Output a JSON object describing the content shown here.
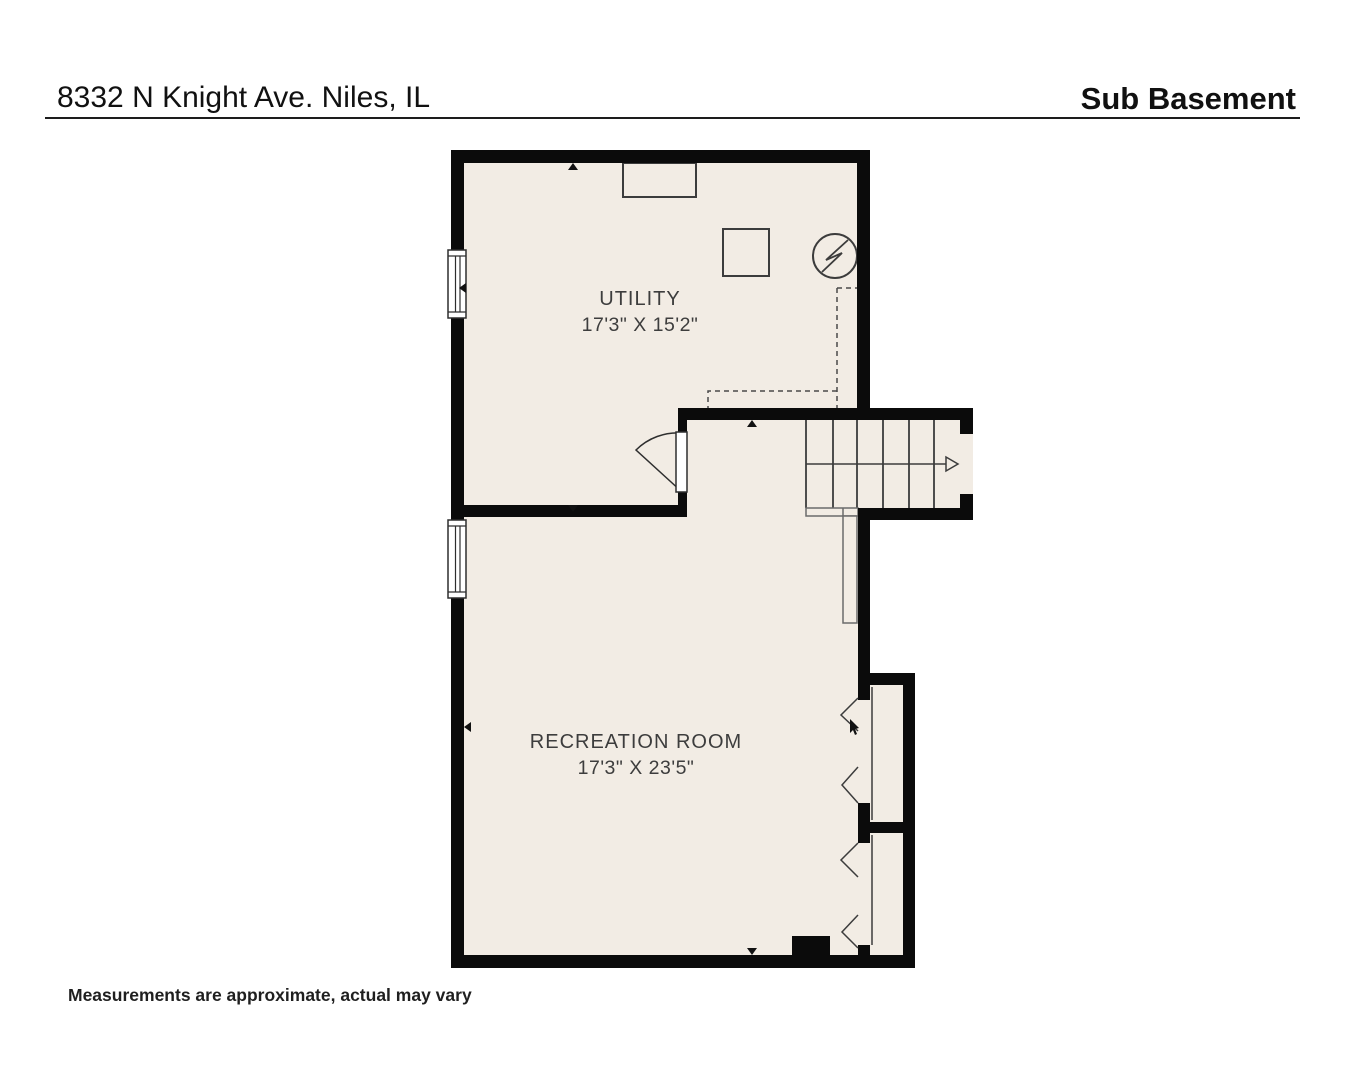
{
  "header": {
    "address": "8332 N Knight Ave. Niles, IL",
    "plan_title": "Sub Basement"
  },
  "rooms": [
    {
      "name": "UTILITY",
      "dimensions": "17'3\" X 15'2\""
    },
    {
      "name": "RECREATION ROOM",
      "dimensions": "17'3\" X 23'5\""
    }
  ],
  "footer": {
    "disclaimer": "Measurements are approximate, actual may vary"
  },
  "icons": [
    "water-heater-icon",
    "furnace-icon",
    "shelf-icon",
    "stairs-up-arrow-icon",
    "window-icon",
    "door-swing-icon",
    "bifold-door-icon",
    "chimney-icon"
  ],
  "colors": {
    "room_fill": "#f2ece4",
    "wall": "#0b0b0b",
    "thin_line": "#3c3c3c",
    "label_text": "#3d3d3d",
    "page_bg": "#ffffff"
  }
}
